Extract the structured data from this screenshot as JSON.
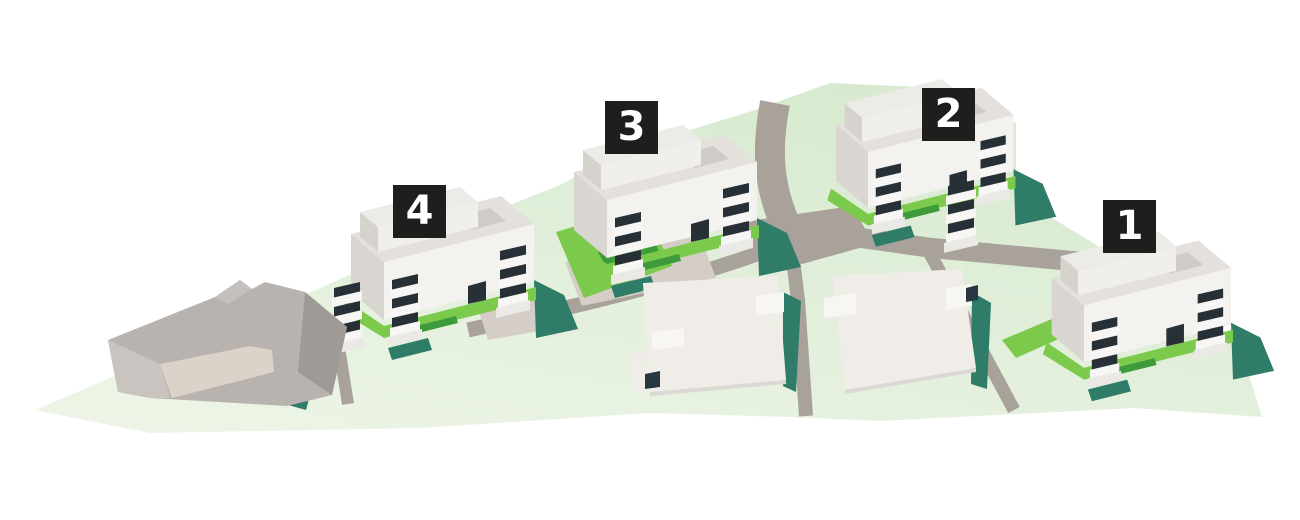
{
  "colors": {
    "background": "#ffffff",
    "ground-light": "#eef5e8",
    "ground-dark": "#d7eacf",
    "road": "#a9a29b",
    "paving": "#d5cec7",
    "grass": "#7bca4c",
    "grass-dark": "#3f9a3c",
    "shadow-teal": "#2f7d68",
    "building-face": "#f4f2ef",
    "building-roof": "#e4e1dd",
    "balcony-dark": "#273037",
    "balcony-slab": "#f8f6f4",
    "existing-top": "#b9b3af",
    "label-bg": "#1e1e1c",
    "label-text": "#ffffff"
  },
  "label_size": 53,
  "labels": [
    {
      "number": "1",
      "x": 1103,
      "y": 200
    },
    {
      "number": "2",
      "x": 922,
      "y": 88
    },
    {
      "number": "3",
      "x": 605,
      "y": 101
    },
    {
      "number": "4",
      "x": 393,
      "y": 185
    }
  ]
}
